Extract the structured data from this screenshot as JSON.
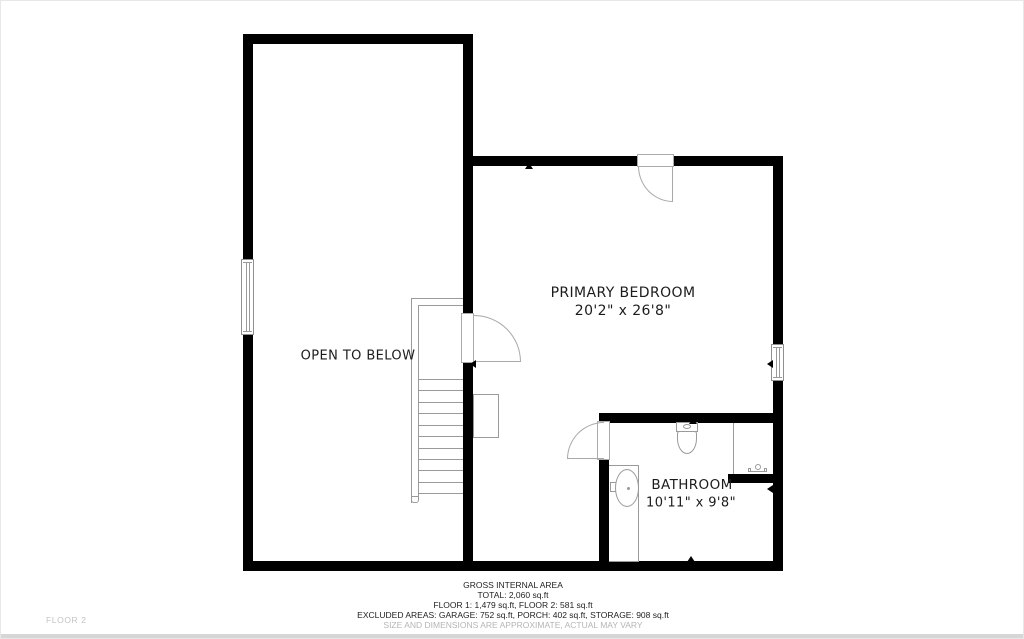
{
  "plan": {
    "floor_label": "FLOOR 2",
    "wall_color": "#000000",
    "line_color": "#9a9a9a",
    "rooms": [
      {
        "name": "OPEN TO BELOW",
        "dimensions": ""
      },
      {
        "name": "PRIMARY BEDROOM",
        "dimensions": "20'2\" x 26'8\""
      },
      {
        "name": "BATHROOM",
        "dimensions": "10'11\" x 9'8\""
      }
    ]
  },
  "footer": {
    "line1": "GROSS INTERNAL AREA",
    "line2": "TOTAL: 2,060 sq.ft",
    "line3": "FLOOR 1: 1,479 sq.ft, FLOOR 2: 581 sq.ft",
    "line4": "EXCLUDED AREAS: GARAGE: 752 sq.ft, PORCH: 402 sq.ft, STORAGE: 908 sq.ft",
    "disclaimer": "SIZE AND DIMENSIONS ARE APPROXIMATE, ACTUAL MAY VARY"
  }
}
